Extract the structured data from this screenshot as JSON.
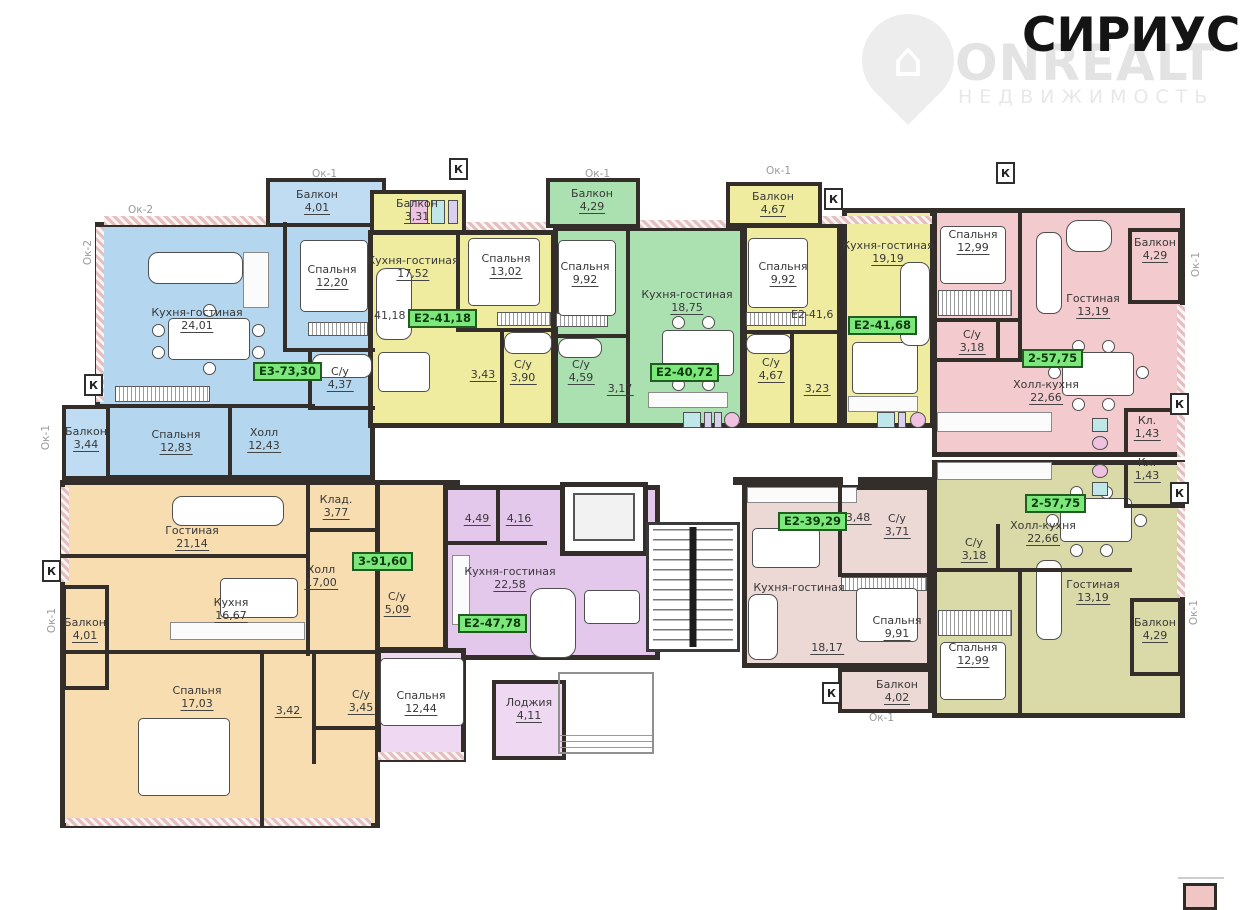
{
  "brand": {
    "logo": "СИРИУС",
    "watermark_title": "ONREALT",
    "watermark_subtitle": "НЕДВИЖИМОСТЬ"
  },
  "markers": {
    "k": "К",
    "ok1": "Ок-1",
    "ok2": "Ок-2"
  },
  "stray_labels": {
    "a": "41,18",
    "b": "Е2-41,6"
  },
  "badges": {
    "blue": "Е3-73,30",
    "yellow_a": "Е2-41,18",
    "green": "Е2-40,72",
    "yellow_c": "Е2-41,68",
    "pink": "2-57,75",
    "olive": "2-57,75",
    "light_pink": "Е2-39,29",
    "purple": "Е2-47,78",
    "orange": "3-91,60"
  },
  "rooms": {
    "blue_kitchen": {
      "name": "Кухня-гостиная",
      "area": "24,01"
    },
    "blue_bedroom1": {
      "name": "Спальня",
      "area": "12,20"
    },
    "blue_bedroom2": {
      "name": "Спальня",
      "area": "12,83"
    },
    "blue_hall": {
      "name": "Холл",
      "area": "12,43"
    },
    "blue_bath": {
      "name": "С/у",
      "area": "4,37"
    },
    "blue_balcony_top": {
      "name": "Балкон",
      "area": "4,01"
    },
    "blue_balcony_left": {
      "name": "Балкон",
      "area": "3,44"
    },
    "ya_balcony": {
      "name": "Балкон",
      "area": "3,31"
    },
    "ya_kitchen": {
      "name": "Кухня-гостиная",
      "area": "17,52"
    },
    "ya_bedroom": {
      "name": "Спальня",
      "area": "13,02"
    },
    "ya_hall": {
      "area": "3,43"
    },
    "ya_bath": {
      "name": "С/у",
      "area": "3,90"
    },
    "green_balcony": {
      "name": "Балкон",
      "area": "4,29"
    },
    "green_bedroom": {
      "name": "Спальня",
      "area": "9,92"
    },
    "green_bath": {
      "name": "С/у",
      "area": "4,59"
    },
    "green_hall": {
      "area": "3,17"
    },
    "green_kitchen": {
      "name": "Кухня-гостиная",
      "area": "18,75"
    },
    "yb_balcony": {
      "name": "Балкон",
      "area": "4,67"
    },
    "yb_bedroom": {
      "name": "Спальня",
      "area": "9,92"
    },
    "yb_bath": {
      "name": "С/у",
      "area": "4,67"
    },
    "yb_hall": {
      "area": "3,23"
    },
    "yc_kitchen": {
      "name": "Кухня-гостиная",
      "area": "19,19"
    },
    "pink_bedroom": {
      "name": "Спальня",
      "area": "12,99"
    },
    "pink_living": {
      "name": "Гостиная",
      "area": "13,19"
    },
    "pink_balcony": {
      "name": "Балкон",
      "area": "4,29"
    },
    "pink_bath": {
      "name": "С/у",
      "area": "3,18"
    },
    "pink_hall_kitchen": {
      "name": "Холл-кухня",
      "area": "22,66"
    },
    "pink_closet": {
      "name": "Кл.",
      "area": "1,43"
    },
    "olive_hall_kitchen": {
      "name": "Холл-кухня",
      "area": "22,66"
    },
    "olive_closet": {
      "name": "Кл.",
      "area": "1,43"
    },
    "olive_bath": {
      "name": "С/у",
      "area": "3,18"
    },
    "olive_living": {
      "name": "Гостиная",
      "area": "13,19"
    },
    "olive_bedroom": {
      "name": "Спальня",
      "area": "12,99"
    },
    "olive_balcony": {
      "name": "Балкон",
      "area": "4,29"
    },
    "lp_kitchen": {
      "name": "Кухня-гостиная",
      "area": "18,17"
    },
    "lp_hall": {
      "area": "3,48"
    },
    "lp_bath": {
      "name": "С/у",
      "area": "3,71"
    },
    "lp_bedroom": {
      "name": "Спальня",
      "area": "9,91"
    },
    "lp_balcony": {
      "name": "Балкон",
      "area": "4,02"
    },
    "or_living": {
      "name": "Гостиная",
      "area": "21,14"
    },
    "or_closet": {
      "name": "Клад.",
      "area": "3,77"
    },
    "or_hall": {
      "name": "Холл",
      "area": "17,00"
    },
    "or_kitchen": {
      "name": "Кухня",
      "area": "16,67"
    },
    "or_bath1": {
      "name": "С/у",
      "area": "5,09"
    },
    "or_balcony": {
      "name": "Балкон",
      "area": "4,01"
    },
    "or_bedroom": {
      "name": "Спальня",
      "area": "17,03"
    },
    "or_ward": {
      "area": "3,42"
    },
    "or_bath2": {
      "name": "С/у",
      "area": "3,45"
    },
    "pu_hall1": {
      "area": "4,49"
    },
    "pu_hall2": {
      "area": "4,16"
    },
    "pu_kitchen": {
      "name": "Кухня-гостиная",
      "area": "22,58"
    },
    "pu_bedroom": {
      "name": "Спальня",
      "area": "12,44"
    },
    "pu_loggia": {
      "name": "Лоджия",
      "area": "4,11"
    }
  }
}
